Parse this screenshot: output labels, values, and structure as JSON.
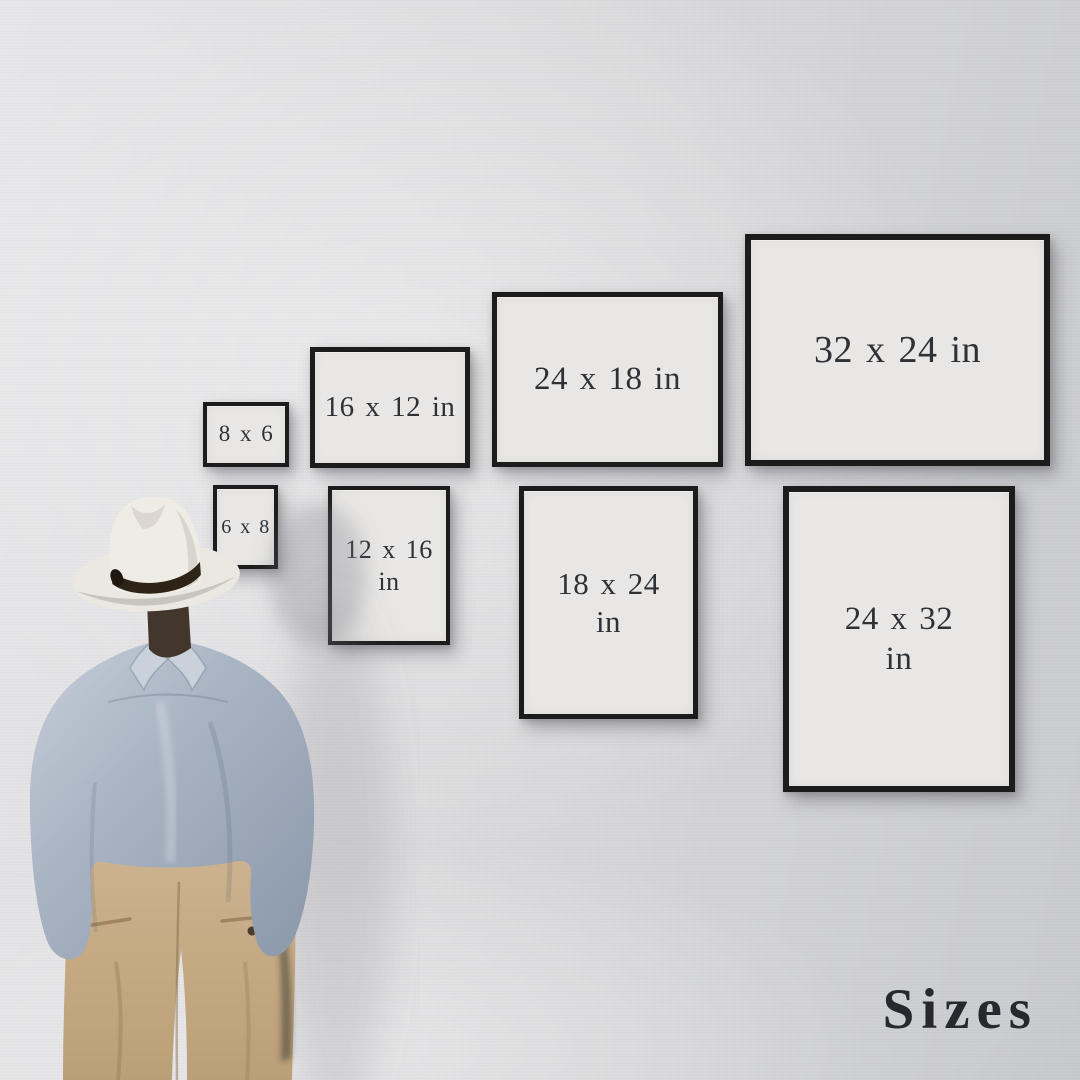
{
  "caption": {
    "text": "Sizes"
  },
  "frames": [
    {
      "name": "frame-8x6",
      "label": "8 x 6",
      "orientation": "landscape"
    },
    {
      "name": "frame-16x12",
      "label": "16 x 12 in",
      "orientation": "landscape"
    },
    {
      "name": "frame-24x18",
      "label": "24 x 18 in",
      "orientation": "landscape"
    },
    {
      "name": "frame-32x24",
      "label": "32 x 24 in",
      "orientation": "landscape"
    },
    {
      "name": "frame-6x8",
      "label": "6 x 8",
      "orientation": "portrait"
    },
    {
      "name": "frame-12x16",
      "label": "12 x 16\nin",
      "orientation": "portrait"
    },
    {
      "name": "frame-18x24",
      "label": "18 x 24\nin",
      "orientation": "portrait"
    },
    {
      "name": "frame-24x32",
      "label": "24 x 32\nin",
      "orientation": "portrait"
    }
  ],
  "colors": {
    "wall_light": "#eaeaec",
    "wall_mid": "#dcdcde",
    "wall_dark": "#cbccd0",
    "frame_border": "#1c1c1c",
    "frame_paper": "#e8e7e5",
    "frame_text": "#2e3237",
    "title_color": "#26292e",
    "hat": "#ebe8e1",
    "hat_band": "#2d2417",
    "hair": "#43362c",
    "shirt": "#a9b4c3",
    "shirt_light": "#c9d1da",
    "shirt_dark": "#8d9aac",
    "pants": "#ccb28e",
    "pants_dark": "#bb9f77"
  }
}
